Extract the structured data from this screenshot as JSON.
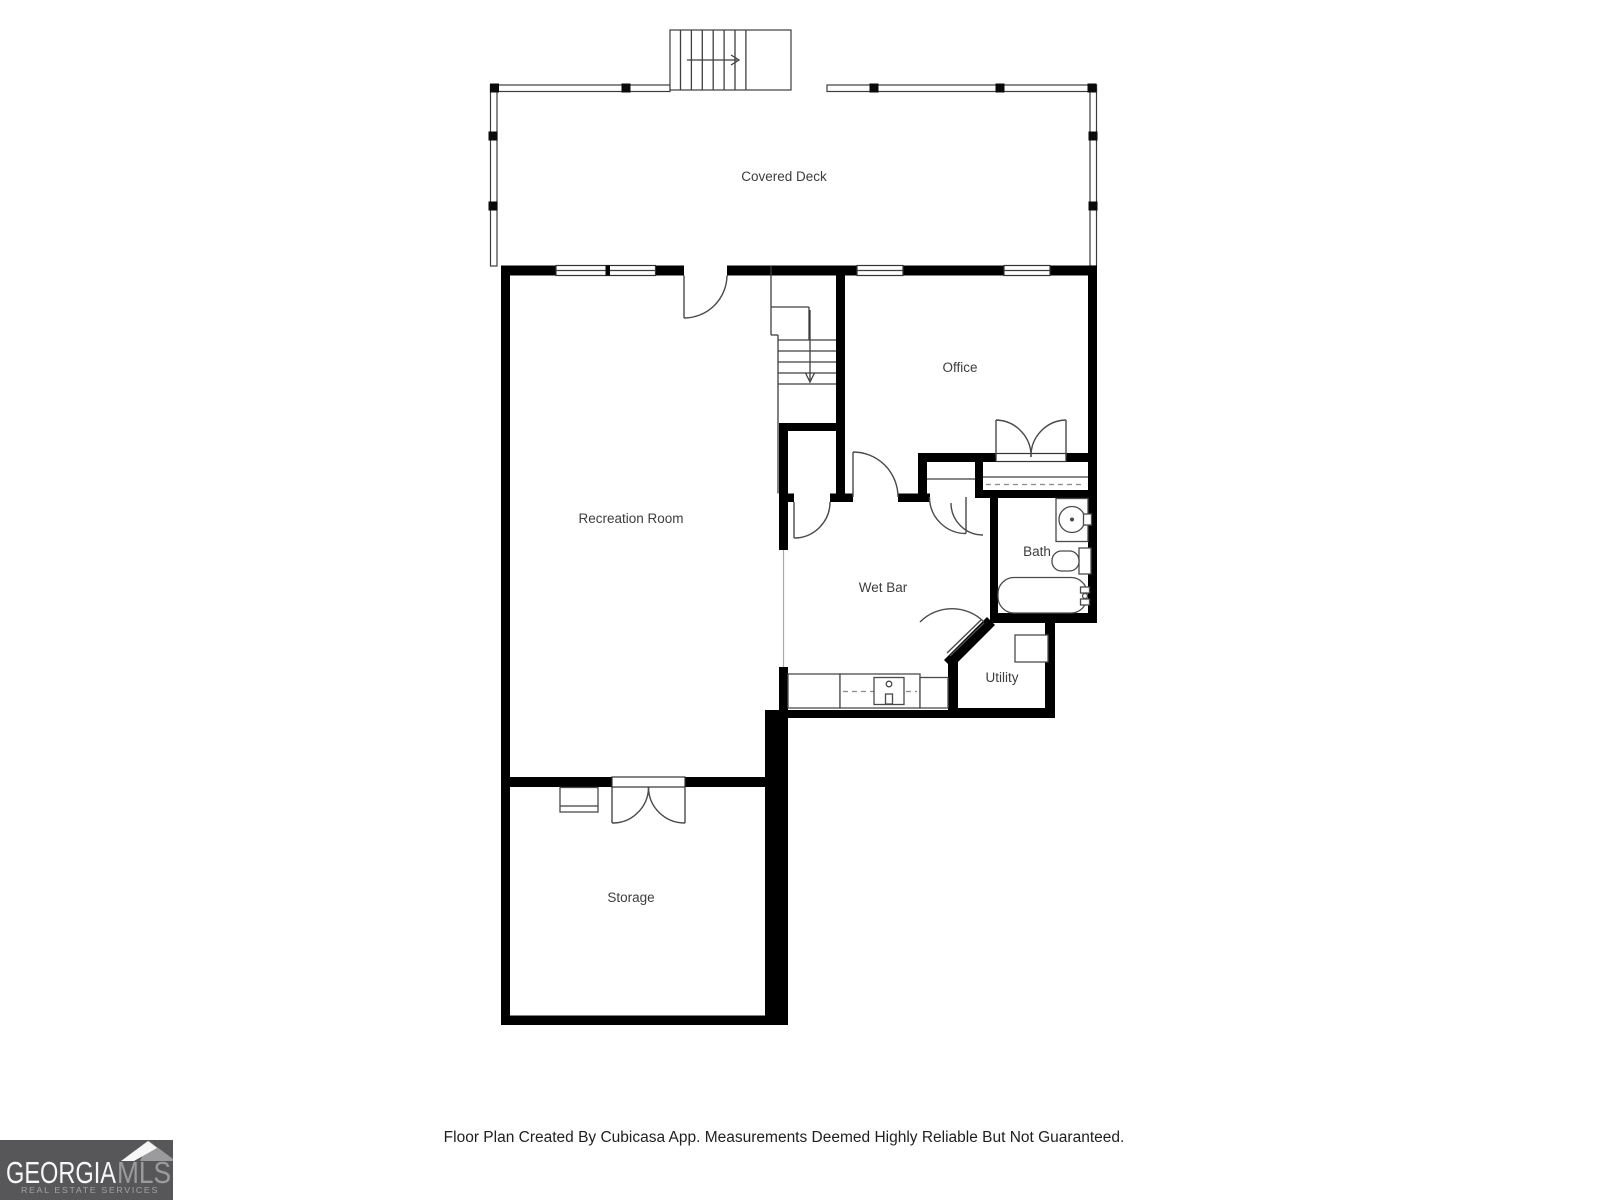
{
  "floor_plan": {
    "rooms": [
      {
        "id": "covered_deck",
        "label": "Covered Deck"
      },
      {
        "id": "office",
        "label": "Office"
      },
      {
        "id": "recreation_room",
        "label": "Recreation Room"
      },
      {
        "id": "wet_bar",
        "label": "Wet Bar"
      },
      {
        "id": "bath",
        "label": "Bath"
      },
      {
        "id": "utility",
        "label": "Utility"
      },
      {
        "id": "storage",
        "label": "Storage"
      }
    ],
    "colors": {
      "wall": "#000000",
      "thin_line": "#3f3f3f",
      "label_text": "#3d3d3d"
    }
  },
  "footer": {
    "disclaimer": "Floor Plan Created By Cubicasa App. Measurements Deemed Highly Reliable But Not Guaranteed."
  },
  "logo": {
    "brand_primary": "GEORGIA",
    "brand_secondary": "MLS",
    "tagline": "REAL ESTATE SERVICES",
    "background": "#57575a",
    "primary_color": "#f7f7f7",
    "secondary_color": "#9b9b9e"
  }
}
